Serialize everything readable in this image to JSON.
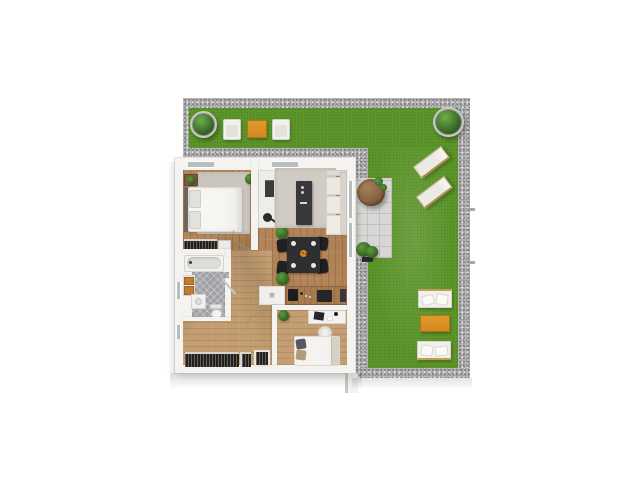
{
  "meta": {
    "title": "Apartment floor plan with garden terrace",
    "canvas": {
      "width": 640,
      "height": 480
    },
    "view": "top-down 3D render on white background"
  },
  "palette": {
    "lawn": "#5a9428",
    "gravel": "#b5b5b5",
    "wall": "#f4f3f0",
    "wood": "#b28457",
    "wood_light": "#c49e72",
    "rug": "#cac6bf",
    "living_rug": "#d0ccc4",
    "tile": "#a0a1a5",
    "patio_tile": "#d8d7d5",
    "patio_line": "#c2c1bf",
    "dark_furn": "#323236",
    "accent_orange": "#d2891f",
    "white_furn": "#f2f1ed",
    "plant_green": "#3e7229",
    "wicker": "#8a6442"
  },
  "icons": {
    "hob_symbol": "❋"
  },
  "garden": {
    "label": "Garden terrace with lawn and gravel border",
    "items": {
      "planter_tl": {
        "label": "Round planter with shrub"
      },
      "armchair_left": {
        "label": "White garden armchair"
      },
      "table_top": {
        "label": "Orange garden side table"
      },
      "armchair_right": {
        "label": "White garden armchair"
      },
      "planter_tr": {
        "label": "Round planter with shrub"
      },
      "lounger_1": {
        "label": "Sun lounger"
      },
      "lounger_2": {
        "label": "Sun lounger"
      },
      "sofa_1": {
        "label": "Garden sofa with cushions"
      },
      "table_right": {
        "label": "Orange garden table"
      },
      "sofa_2": {
        "label": "Garden sofa with cushions"
      },
      "wicker_planter": {
        "label": "Wicker planter"
      },
      "patio_shrub": {
        "label": "Potted shrub"
      },
      "patio": {
        "label": "Paved patio"
      }
    }
  },
  "apartment": {
    "label": "Apartment",
    "rooms": {
      "bedroom": {
        "label": "Bedroom with double bed, rug and wardrobe"
      },
      "living": {
        "label": "Open living room and kitchen"
      },
      "bathroom": {
        "label": "Bathroom with bathtub, vanity and toilet"
      },
      "hallway": {
        "label": "Hallway with built-in wardrobes"
      },
      "bedroom2": {
        "label": "Second bedroom with desk and bed"
      }
    },
    "furniture": {
      "bed": {
        "label": "Double bed"
      },
      "nightstand": {
        "label": "Nightstand with plant"
      },
      "wardrobe": {
        "label": "Slatted wardrobe"
      },
      "island": {
        "label": "Kitchen island"
      },
      "sofa": {
        "label": "Sofa"
      },
      "dining": {
        "label": "Dining table with four chairs"
      },
      "counter": {
        "label": "Kitchen counter with sink and hob"
      },
      "bathtub": {
        "label": "Bathtub"
      },
      "toilet": {
        "label": "Toilet"
      },
      "vanity": {
        "label": "Vanity with orange drawers"
      },
      "desk": {
        "label": "Desk with chair"
      },
      "bed2": {
        "label": "Single bed"
      }
    }
  }
}
